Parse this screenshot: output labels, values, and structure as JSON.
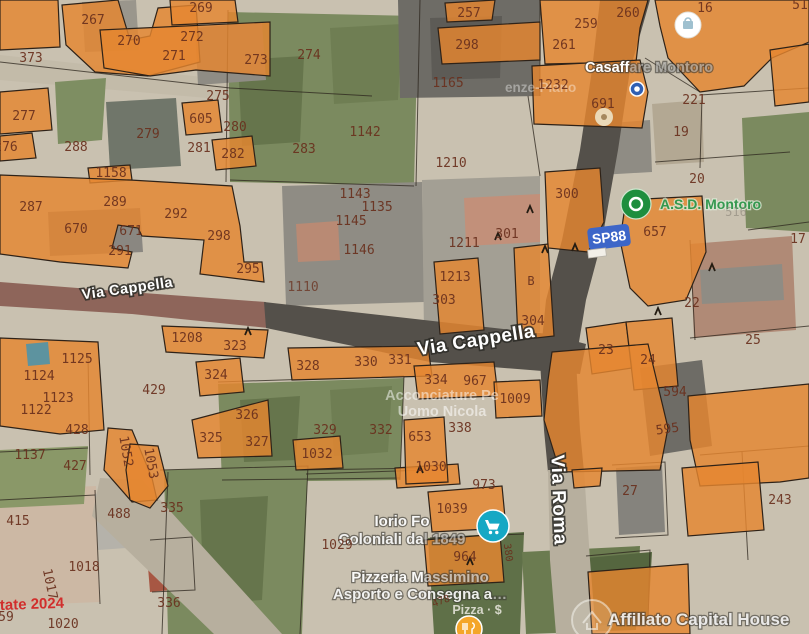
{
  "map": {
    "colors": {
      "base": "#c9c1b0",
      "parcel": "#e5862f",
      "parcel_stroke": "#2e2218",
      "parcel_label": "#69301d",
      "boundary": "#2b241c",
      "badge": "#3d66c8",
      "poi_green": "#1e8e3e",
      "cart_teal": "#16a8c4",
      "road_dark": "#54504a",
      "road_red": "#8e655a",
      "road_light": "#b7af9e"
    },
    "patches": [
      {
        "f": "#c3bba9",
        "p": "0,55 230,80 372,90 372,108 230,100 0,80"
      },
      {
        "f": "#7b8a5f",
        "p": "228,12 418,16 414,186 230,182"
      },
      {
        "f": "#66754c",
        "p": "238,60 304,56 300,142 242,146"
      },
      {
        "f": "#6f7e53",
        "p": "330,28 402,24 398,100 334,104"
      },
      {
        "f": "#6e6c66",
        "p": "398,0 540,0 540,96 400,98"
      },
      {
        "f": "#5d5b56",
        "p": "430,18 502,16 500,78 432,80"
      },
      {
        "f": "#8f8c84",
        "p": "195,28 262,22 266,80 198,85"
      },
      {
        "f": "#9a968c",
        "p": "82,2 136,0 139,50 85,52"
      },
      {
        "f": "#70766a",
        "p": "106,102 176,98 181,166 110,170"
      },
      {
        "f": "#7e8e62",
        "p": "55,82 106,78 102,140 58,144"
      },
      {
        "f": "#8a8781",
        "p": "48,212 140,208 143,252 50,256"
      },
      {
        "f": "#8f8c84",
        "p": "282,186 422,182 424,302 286,306"
      },
      {
        "f": "#b98a74",
        "p": "296,224 338,221 340,260 298,262"
      },
      {
        "f": "#a39f94",
        "p": "422,180 540,176 540,332 424,334"
      },
      {
        "f": "#c2907a",
        "p": "464,198 540,194 540,242 466,246"
      },
      {
        "f": "#b3a893",
        "p": "652,104 702,100 704,162 656,165"
      },
      {
        "f": "#8f8c84",
        "p": "598,124 650,120 652,172 600,175"
      },
      {
        "f": "#7b8a5f",
        "p": "742,118 809,112 809,232 746,228"
      },
      {
        "f": "#b08a76",
        "p": "690,244 792,236 796,330 694,338"
      },
      {
        "f": "#8f8c84",
        "p": "700,270 782,264 784,300 702,304"
      },
      {
        "f": "#7b8a5f",
        "p": "218,384 404,378 400,480 222,482"
      },
      {
        "f": "#66754c",
        "p": "240,400 300,396 296,460 244,462"
      },
      {
        "f": "#6f7e53",
        "p": "330,390 392,386 388,452 334,456"
      },
      {
        "f": "#6e6c66",
        "p": "640,368 702,360 712,446 650,456"
      },
      {
        "f": "#ccb8a4",
        "p": "0,490 96,486 100,602 0,606"
      },
      {
        "f": "#b5b2aa",
        "p": "95,494 152,490 156,546 98,550"
      },
      {
        "f": "#a75743",
        "p": "146,542 188,538 192,588 150,592"
      },
      {
        "f": "#7b8a5f",
        "p": "164,470 308,466 302,634 168,634"
      },
      {
        "f": "#66754c",
        "p": "200,500 268,496 262,600 204,604"
      },
      {
        "f": "#5f7048",
        "p": "428,538 524,532 520,634 434,634"
      },
      {
        "f": "#6b7b50",
        "p": "522,552 640,546 636,630 526,634"
      },
      {
        "f": "#55663f",
        "p": "586,558 652,552 648,622 592,626"
      },
      {
        "f": "#b7af9e",
        "p": "100,478 142,480 282,634 214,634 92,516"
      },
      {
        "f": "#85837d",
        "p": "616,468 662,465 665,532 619,535"
      },
      {
        "f": "#8a9868",
        "p": "0,450 88,446 84,504 0,508"
      }
    ],
    "roads": [
      {
        "f": "#8e655a",
        "p": "0,282 130,292 266,302 268,328 132,314 0,306"
      },
      {
        "f": "#54504a",
        "p": "264,302 548,334 586,344 580,374 430,362 266,328"
      },
      {
        "f": "#54504a",
        "p": "600,0 592,70 580,150 562,240 546,300 540,360 544,430 548,472 584,472 580,430 576,360 586,300 602,240 618,150 630,70 650,0"
      },
      {
        "f": "#b7af9e",
        "p": "548,470 584,470 590,560 596,634 556,634 550,560"
      }
    ],
    "lines": [
      "0,62 230,88 372,96",
      "228,10 226,182",
      "420,0 416,186",
      "230,180 414,186",
      "540,0 540,96",
      "700,95 809,88",
      "645,58 700,92",
      "702,96 700,168",
      "655,162 790,152",
      "748,230 809,222",
      "690,240 695,340",
      "690,338 809,326",
      "218,382 404,376",
      "222,480 400,478",
      "404,376 400,480",
      "88,355 90,475",
      "160,470 308,466 300,634",
      "168,472 162,634",
      "0,452 88,448",
      "430,538 524,534",
      "586,556 650,550 648,624",
      "300,470 430,468",
      "612,465 665,462 668,535 615,538",
      "700,455 809,446",
      "742,452 748,560",
      "0,500 95,495",
      "95,490 100,604",
      "150,540 192,537 195,590 152,592",
      "306,474 428,470",
      "528,96 540,176"
    ],
    "parcels": [
      "0,0 58,0 60,47 0,50",
      "62,5 118,0 130,40 150,36 158,8 196,5 200,62 148,76 95,72 66,45",
      "170,0 235,0 238,22 172,25",
      "100,30 270,22 270,76 196,70 150,76 104,68",
      "0,92 48,88 52,130 0,134",
      "0,136 32,133 36,158 0,161",
      "182,103 218,100 222,132 186,135",
      "212,140 252,136 256,166 216,170",
      "88,168 130,165 132,180 90,183",
      "0,175 130,180 232,186 240,226 244,262 262,262 264,282 200,274 204,240 142,236 138,228 118,225 112,248 132,252 128,268 60,262 0,254",
      "445,3 495,0 492,20 447,22",
      "438,28 540,22 540,60 442,64",
      "540,0 648,0 640,28 636,62 545,64",
      "532,66 640,60 648,92 642,128 534,124",
      "655,0 809,0 809,42 772,58 744,86 700,92 668,58 660,26",
      "770,50 809,44 809,102 775,106",
      "545,172 600,168 604,222 588,252 548,248",
      "626,200 702,196 706,252 686,300 648,306 630,288 620,240",
      "434,262 478,258 484,330 440,334",
      "514,248 548,244 554,336 518,340",
      "586,328 626,322 632,368 592,374",
      "626,322 672,318 678,386 634,390",
      "552,352 648,344 668,428 660,470 560,472 544,420 548,380",
      "688,396 809,384 809,478 780,482 700,486 690,440",
      "572,470 602,468 600,486 574,488",
      "682,468 758,462 764,530 688,536",
      "588,572 688,564 690,634 592,634",
      "428,492 502,486 506,528 432,532",
      "424,540 500,534 504,582 428,586",
      "395,468 458,464 460,484 397,488",
      "404,420 444,417 448,482 406,484",
      "293,440 340,436 343,468 296,470",
      "288,348 428,346 432,376 292,380",
      "414,366 494,362 498,396 418,399",
      "494,382 540,380 542,416 496,418",
      "196,362 240,358 244,392 200,396",
      "162,326 268,330 264,358 166,352",
      "192,420 268,400 272,456 198,458",
      "0,338 98,342 104,430 60,434 0,426",
      "108,428 132,430 152,478 157,500 132,502 104,470",
      "130,444 158,446 168,486 150,508 130,500 126,470"
    ],
    "overlays": [
      {
        "f": "#4f93a8",
        "p": "26,344 48,342 50,364 28,366",
        "o": 0.9
      }
    ],
    "hooks": [
      "498,237",
      "545,250",
      "575,248",
      "712,268",
      "248,332",
      "658,312",
      "470,562",
      "420,470",
      "530,210"
    ],
    "parcel_labels": [
      {
        "t": "267",
        "x": 93,
        "y": 24
      },
      {
        "t": "269",
        "x": 201,
        "y": 12
      },
      {
        "t": "270",
        "x": 129,
        "y": 45
      },
      {
        "t": "272",
        "x": 192,
        "y": 41
      },
      {
        "t": "271",
        "x": 174,
        "y": 60
      },
      {
        "t": "273",
        "x": 256,
        "y": 64
      },
      {
        "t": "373",
        "x": 31,
        "y": 62
      },
      {
        "t": "275",
        "x": 218,
        "y": 100
      },
      {
        "t": "277",
        "x": 24,
        "y": 120
      },
      {
        "t": "605",
        "x": 201,
        "y": 123
      },
      {
        "t": "280",
        "x": 235,
        "y": 131
      },
      {
        "t": "279",
        "x": 148,
        "y": 138
      },
      {
        "t": "281",
        "x": 199,
        "y": 152
      },
      {
        "t": "282",
        "x": 233,
        "y": 158
      },
      {
        "t": "288",
        "x": 76,
        "y": 151
      },
      {
        "t": "276",
        "x": 6,
        "y": 151
      },
      {
        "t": "283",
        "x": 304,
        "y": 153
      },
      {
        "t": "274",
        "x": 309,
        "y": 59
      },
      {
        "t": "257",
        "x": 469,
        "y": 17
      },
      {
        "t": "298",
        "x": 467,
        "y": 49
      },
      {
        "t": "1165",
        "x": 448,
        "y": 87
      },
      {
        "t": "1142",
        "x": 365,
        "y": 136
      },
      {
        "t": "1210",
        "x": 451,
        "y": 167
      },
      {
        "t": "259",
        "x": 586,
        "y": 28
      },
      {
        "t": "260",
        "x": 628,
        "y": 17
      },
      {
        "t": "261",
        "x": 564,
        "y": 49
      },
      {
        "t": "16",
        "x": 705,
        "y": 12
      },
      {
        "t": "51",
        "x": 800,
        "y": 9
      },
      {
        "t": "1232",
        "x": 553,
        "y": 89
      },
      {
        "t": "691",
        "x": 603,
        "y": 108
      },
      {
        "t": "221",
        "x": 694,
        "y": 104
      },
      {
        "t": "19",
        "x": 681,
        "y": 136
      },
      {
        "t": "1158",
        "x": 111,
        "y": 177
      },
      {
        "t": "287",
        "x": 31,
        "y": 211
      },
      {
        "t": "289",
        "x": 115,
        "y": 206
      },
      {
        "t": "292",
        "x": 176,
        "y": 218
      },
      {
        "t": "670",
        "x": 76,
        "y": 233
      },
      {
        "t": "671",
        "x": 131,
        "y": 235
      },
      {
        "t": "291",
        "x": 120,
        "y": 255
      },
      {
        "t": "298",
        "x": 219,
        "y": 240
      },
      {
        "t": "295",
        "x": 248,
        "y": 273
      },
      {
        "t": "1143",
        "x": 355,
        "y": 198
      },
      {
        "t": "1135",
        "x": 377,
        "y": 211
      },
      {
        "t": "1145",
        "x": 351,
        "y": 225
      },
      {
        "t": "1146",
        "x": 359,
        "y": 254
      },
      {
        "t": "1211",
        "x": 464,
        "y": 247
      },
      {
        "t": "301",
        "x": 507,
        "y": 238
      },
      {
        "t": "1213",
        "x": 455,
        "y": 281
      },
      {
        "t": "303",
        "x": 444,
        "y": 304
      },
      {
        "t": "B",
        "x": 531,
        "y": 285,
        "s": 12
      },
      {
        "t": "300",
        "x": 567,
        "y": 198
      },
      {
        "t": "657",
        "x": 655,
        "y": 236
      },
      {
        "t": "20",
        "x": 697,
        "y": 183
      },
      {
        "t": "516",
        "x": 736,
        "y": 216,
        "c": "#8b8378",
        "o": 0.6,
        "s": 12
      },
      {
        "t": "17",
        "x": 798,
        "y": 243
      },
      {
        "t": "22",
        "x": 692,
        "y": 307
      },
      {
        "t": "304",
        "x": 533,
        "y": 325
      },
      {
        "t": "1110",
        "x": 303,
        "y": 291,
        "o": 0.75
      },
      {
        "t": "1125",
        "x": 77,
        "y": 363
      },
      {
        "t": "1124",
        "x": 39,
        "y": 380
      },
      {
        "t": "1123",
        "x": 58,
        "y": 402
      },
      {
        "t": "1122",
        "x": 36,
        "y": 414
      },
      {
        "t": "428",
        "x": 77,
        "y": 434
      },
      {
        "t": "1137",
        "x": 30,
        "y": 459
      },
      {
        "t": "427",
        "x": 75,
        "y": 470
      },
      {
        "t": "1052",
        "x": 122,
        "y": 452,
        "r": 80
      },
      {
        "t": "1053",
        "x": 147,
        "y": 464,
        "r": 80
      },
      {
        "t": "429",
        "x": 154,
        "y": 394
      },
      {
        "t": "1208",
        "x": 187,
        "y": 342
      },
      {
        "t": "323",
        "x": 235,
        "y": 350
      },
      {
        "t": "324",
        "x": 216,
        "y": 379
      },
      {
        "t": "326",
        "x": 247,
        "y": 419
      },
      {
        "t": "325",
        "x": 211,
        "y": 442
      },
      {
        "t": "327",
        "x": 257,
        "y": 446
      },
      {
        "t": "328",
        "x": 308,
        "y": 370
      },
      {
        "t": "330",
        "x": 366,
        "y": 366
      },
      {
        "t": "331",
        "x": 400,
        "y": 364
      },
      {
        "t": "334",
        "x": 436,
        "y": 384
      },
      {
        "t": "967",
        "x": 475,
        "y": 385
      },
      {
        "t": "1009",
        "x": 515,
        "y": 403
      },
      {
        "t": "329",
        "x": 325,
        "y": 434
      },
      {
        "t": "332",
        "x": 381,
        "y": 434
      },
      {
        "t": "338",
        "x": 460,
        "y": 432
      },
      {
        "t": "653",
        "x": 420,
        "y": 441
      },
      {
        "t": "1032",
        "x": 317,
        "y": 458
      },
      {
        "t": "1030",
        "x": 431,
        "y": 471
      },
      {
        "t": "23",
        "x": 606,
        "y": 354
      },
      {
        "t": "24",
        "x": 648,
        "y": 364
      },
      {
        "t": "25",
        "x": 753,
        "y": 344
      },
      {
        "t": "594",
        "x": 675,
        "y": 396
      },
      {
        "t": "595",
        "x": 668,
        "y": 433,
        "r": -8
      },
      {
        "t": "973",
        "x": 484,
        "y": 489
      },
      {
        "t": "1039",
        "x": 452,
        "y": 513
      },
      {
        "t": "964",
        "x": 465,
        "y": 561
      },
      {
        "t": "1029",
        "x": 337,
        "y": 549
      },
      {
        "t": "415",
        "x": 18,
        "y": 525
      },
      {
        "t": "488",
        "x": 119,
        "y": 518
      },
      {
        "t": "335",
        "x": 172,
        "y": 512
      },
      {
        "t": "1018",
        "x": 84,
        "y": 571
      },
      {
        "t": "1017",
        "x": 46,
        "y": 585,
        "r": 78
      },
      {
        "t": "336",
        "x": 169,
        "y": 607
      },
      {
        "t": "1020",
        "x": 63,
        "y": 628
      },
      {
        "t": "59",
        "x": 6,
        "y": 621
      },
      {
        "t": "27",
        "x": 630,
        "y": 495
      },
      {
        "t": "243",
        "x": 780,
        "y": 504
      },
      {
        "t": "380",
        "x": 505,
        "y": 553,
        "r": 82,
        "s": 10
      },
      {
        "t": "478",
        "x": 442,
        "y": 604,
        "r": -20,
        "s": 10
      }
    ],
    "street_labels": [
      {
        "t": "Via Cappella",
        "x": 128,
        "y": 293,
        "r": -8,
        "s": 14.5
      },
      {
        "t": "Via Cappella",
        "x": 477,
        "y": 346,
        "r": -9,
        "s": 19
      },
      {
        "t": "Via Roma",
        "x": 553,
        "y": 500,
        "r": 88,
        "s": 19
      }
    ],
    "road_badge": {
      "t": "SP88",
      "x": 609,
      "y": 237,
      "r": -7
    },
    "poi_labels": [
      {
        "n": "poi-casaffare-montoro",
        "x": 585,
        "y": 72,
        "s": 14.5,
        "a": "start",
        "halo": true,
        "lines": [
          {
            "dy": 0,
            "parts": [
              [
                "Casaff",
                1
              ],
              [
                "are Montoro",
                0.42
              ]
            ]
          }
        ]
      },
      {
        "n": "poi-enze-piano",
        "x": 505,
        "y": 92,
        "s": 13.5,
        "a": "start",
        "halo": false,
        "lines": [
          {
            "dy": 0,
            "parts": [
              [
                "enze-Piano",
                0.38
              ]
            ]
          }
        ]
      },
      {
        "n": "poi-asd-montoro",
        "x": 660,
        "y": 209,
        "s": 14,
        "a": "start",
        "c": "#1e8e3e",
        "halo": true,
        "hc": "#ddead8",
        "ho": 0.8,
        "lines": [
          {
            "dy": 0,
            "parts": [
              [
                "A.S.D. Montoro",
                0.88
              ]
            ]
          }
        ]
      },
      {
        "n": "poi-acconciature-uomo-nicola",
        "x": 442,
        "y": 400,
        "s": 14.5,
        "halo": false,
        "lines": [
          {
            "dy": 0,
            "parts": [
              [
                "Acconciature Pe",
                0.5
              ]
            ]
          },
          {
            "dy": 16,
            "parts": [
              [
                "Uomo Nicola",
                0.55
              ]
            ]
          }
        ]
      },
      {
        "n": "poi-iorio-coloniali",
        "x": 402,
        "y": 526,
        "s": 15,
        "halo": true,
        "lines": [
          {
            "dy": 0,
            "parts": [
              [
                "Iorio Fo",
                0.95
              ]
            ]
          },
          {
            "dy": 18,
            "parts": [
              [
                "Coloniali da",
                0.9
              ],
              [
                "l 1849",
                0.5
              ]
            ]
          }
        ]
      },
      {
        "n": "poi-pizzeria-massimino",
        "x": 420,
        "y": 582,
        "s": 15,
        "halo": true,
        "lines": [
          {
            "dy": 0,
            "parts": [
              [
                "Pizzeria M",
                0.95
              ],
              [
                "assimino",
                0.6
              ]
            ]
          },
          {
            "dy": 17,
            "parts": [
              [
                "Asporto e Consegna a",
                0.9
              ],
              [
                "…",
                0.5
              ]
            ]
          }
        ]
      },
      {
        "n": "poi-pizza-price",
        "x": 477,
        "y": 614,
        "s": 12.5,
        "c": "#f4f1ea",
        "halo": false,
        "lines": [
          {
            "dy": 0,
            "parts": [
              [
                "Pizza · $",
                0.8
              ]
            ]
          }
        ]
      },
      {
        "n": "poi-affiliato-capital-house",
        "x": 608,
        "y": 625,
        "s": 17,
        "a": "start",
        "halo": true,
        "lines": [
          {
            "dy": 0,
            "parts": [
              [
                "Affiliato Capital House",
                0.85
              ]
            ]
          }
        ]
      }
    ],
    "icons": [
      {
        "n": "store-pin",
        "x": 688,
        "y": 25
      },
      {
        "n": "lodging-pin",
        "x": 604,
        "y": 117
      },
      {
        "n": "transit-stop-icon",
        "x": 637,
        "y": 89
      },
      {
        "n": "sports-club-pin",
        "x": 636,
        "y": 204
      },
      {
        "n": "shopping-cart-pin",
        "x": 493,
        "y": 526
      },
      {
        "n": "restaurant-pin",
        "x": 469,
        "y": 629
      },
      {
        "n": "capital-house-logo",
        "x": 592,
        "y": 620
      },
      {
        "n": "road-sign",
        "x": 597,
        "y": 253
      }
    ],
    "watermark": {
      "t": "tate 2024",
      "x": 0,
      "y": 610,
      "c": "#d21f1f",
      "s": 15
    }
  }
}
